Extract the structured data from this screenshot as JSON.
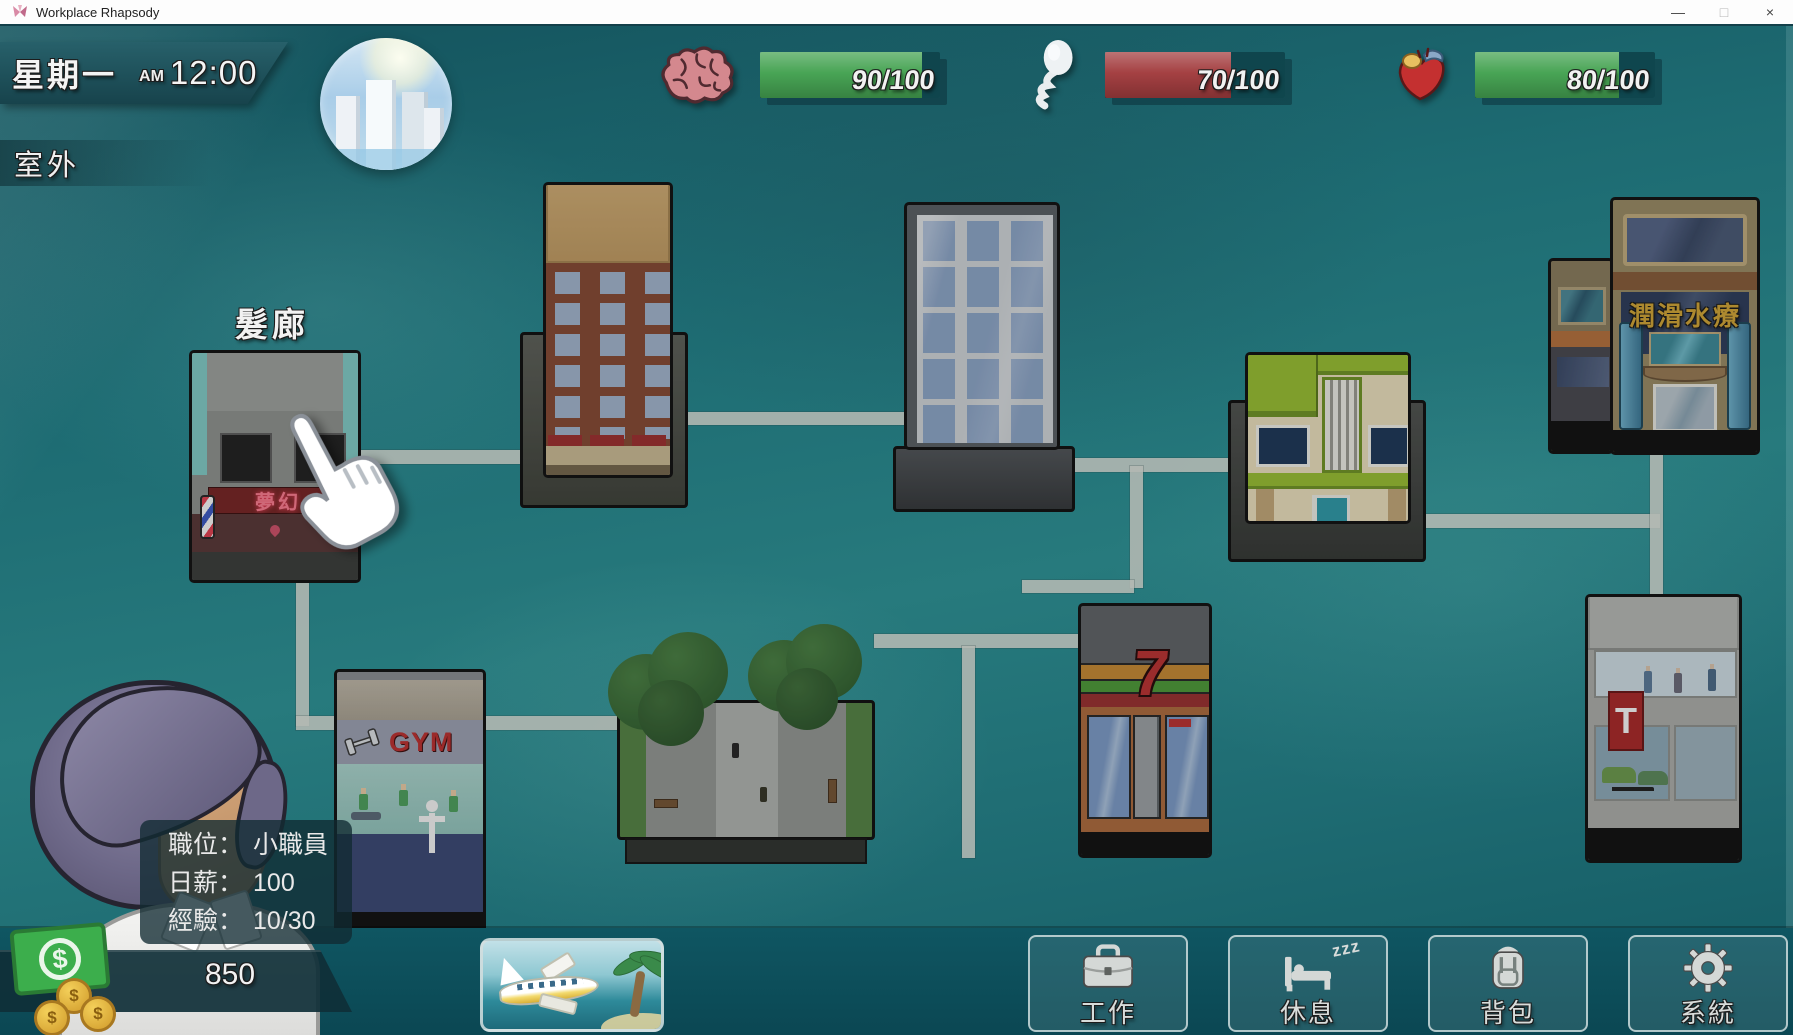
{
  "window": {
    "title": "Workplace Rhapsody",
    "minimize_label": "—",
    "maximize_label": "□",
    "close_label": "×"
  },
  "hud": {
    "day": "星期一",
    "meridiem": "AM",
    "time": "12:00",
    "location": "室外"
  },
  "stats": [
    {
      "id": "intellect",
      "icon": "brain-icon",
      "value": "90/100",
      "pct": 90,
      "fill": "#45a352"
    },
    {
      "id": "libido",
      "icon": "sperm-icon",
      "value": "70/100",
      "pct": 70,
      "fill": "#a33d3f"
    },
    {
      "id": "health",
      "icon": "heart-icon",
      "value": "80/100",
      "pct": 80,
      "fill": "#45a352"
    }
  ],
  "map": {
    "salon_label": "髮廊",
    "salon_sign": "夢幻",
    "spa_sign": "潤滑水療",
    "gym_sign": "GYM",
    "store_sign": "7",
    "dealer_sign": "T"
  },
  "player": {
    "info": [
      {
        "label": "職位：",
        "value": "小職員"
      },
      {
        "label": "日薪：",
        "value": "100"
      },
      {
        "label": "經驗：",
        "value": "10/30"
      }
    ],
    "money": "850"
  },
  "actions": [
    {
      "id": "work",
      "label": "工作",
      "icon": "briefcase-icon"
    },
    {
      "id": "rest",
      "label": "休息",
      "icon": "bed-icon",
      "zzz": "zzz"
    },
    {
      "id": "bag",
      "label": "背包",
      "icon": "backpack-icon"
    },
    {
      "id": "system",
      "label": "系統",
      "icon": "gear-icon"
    }
  ]
}
